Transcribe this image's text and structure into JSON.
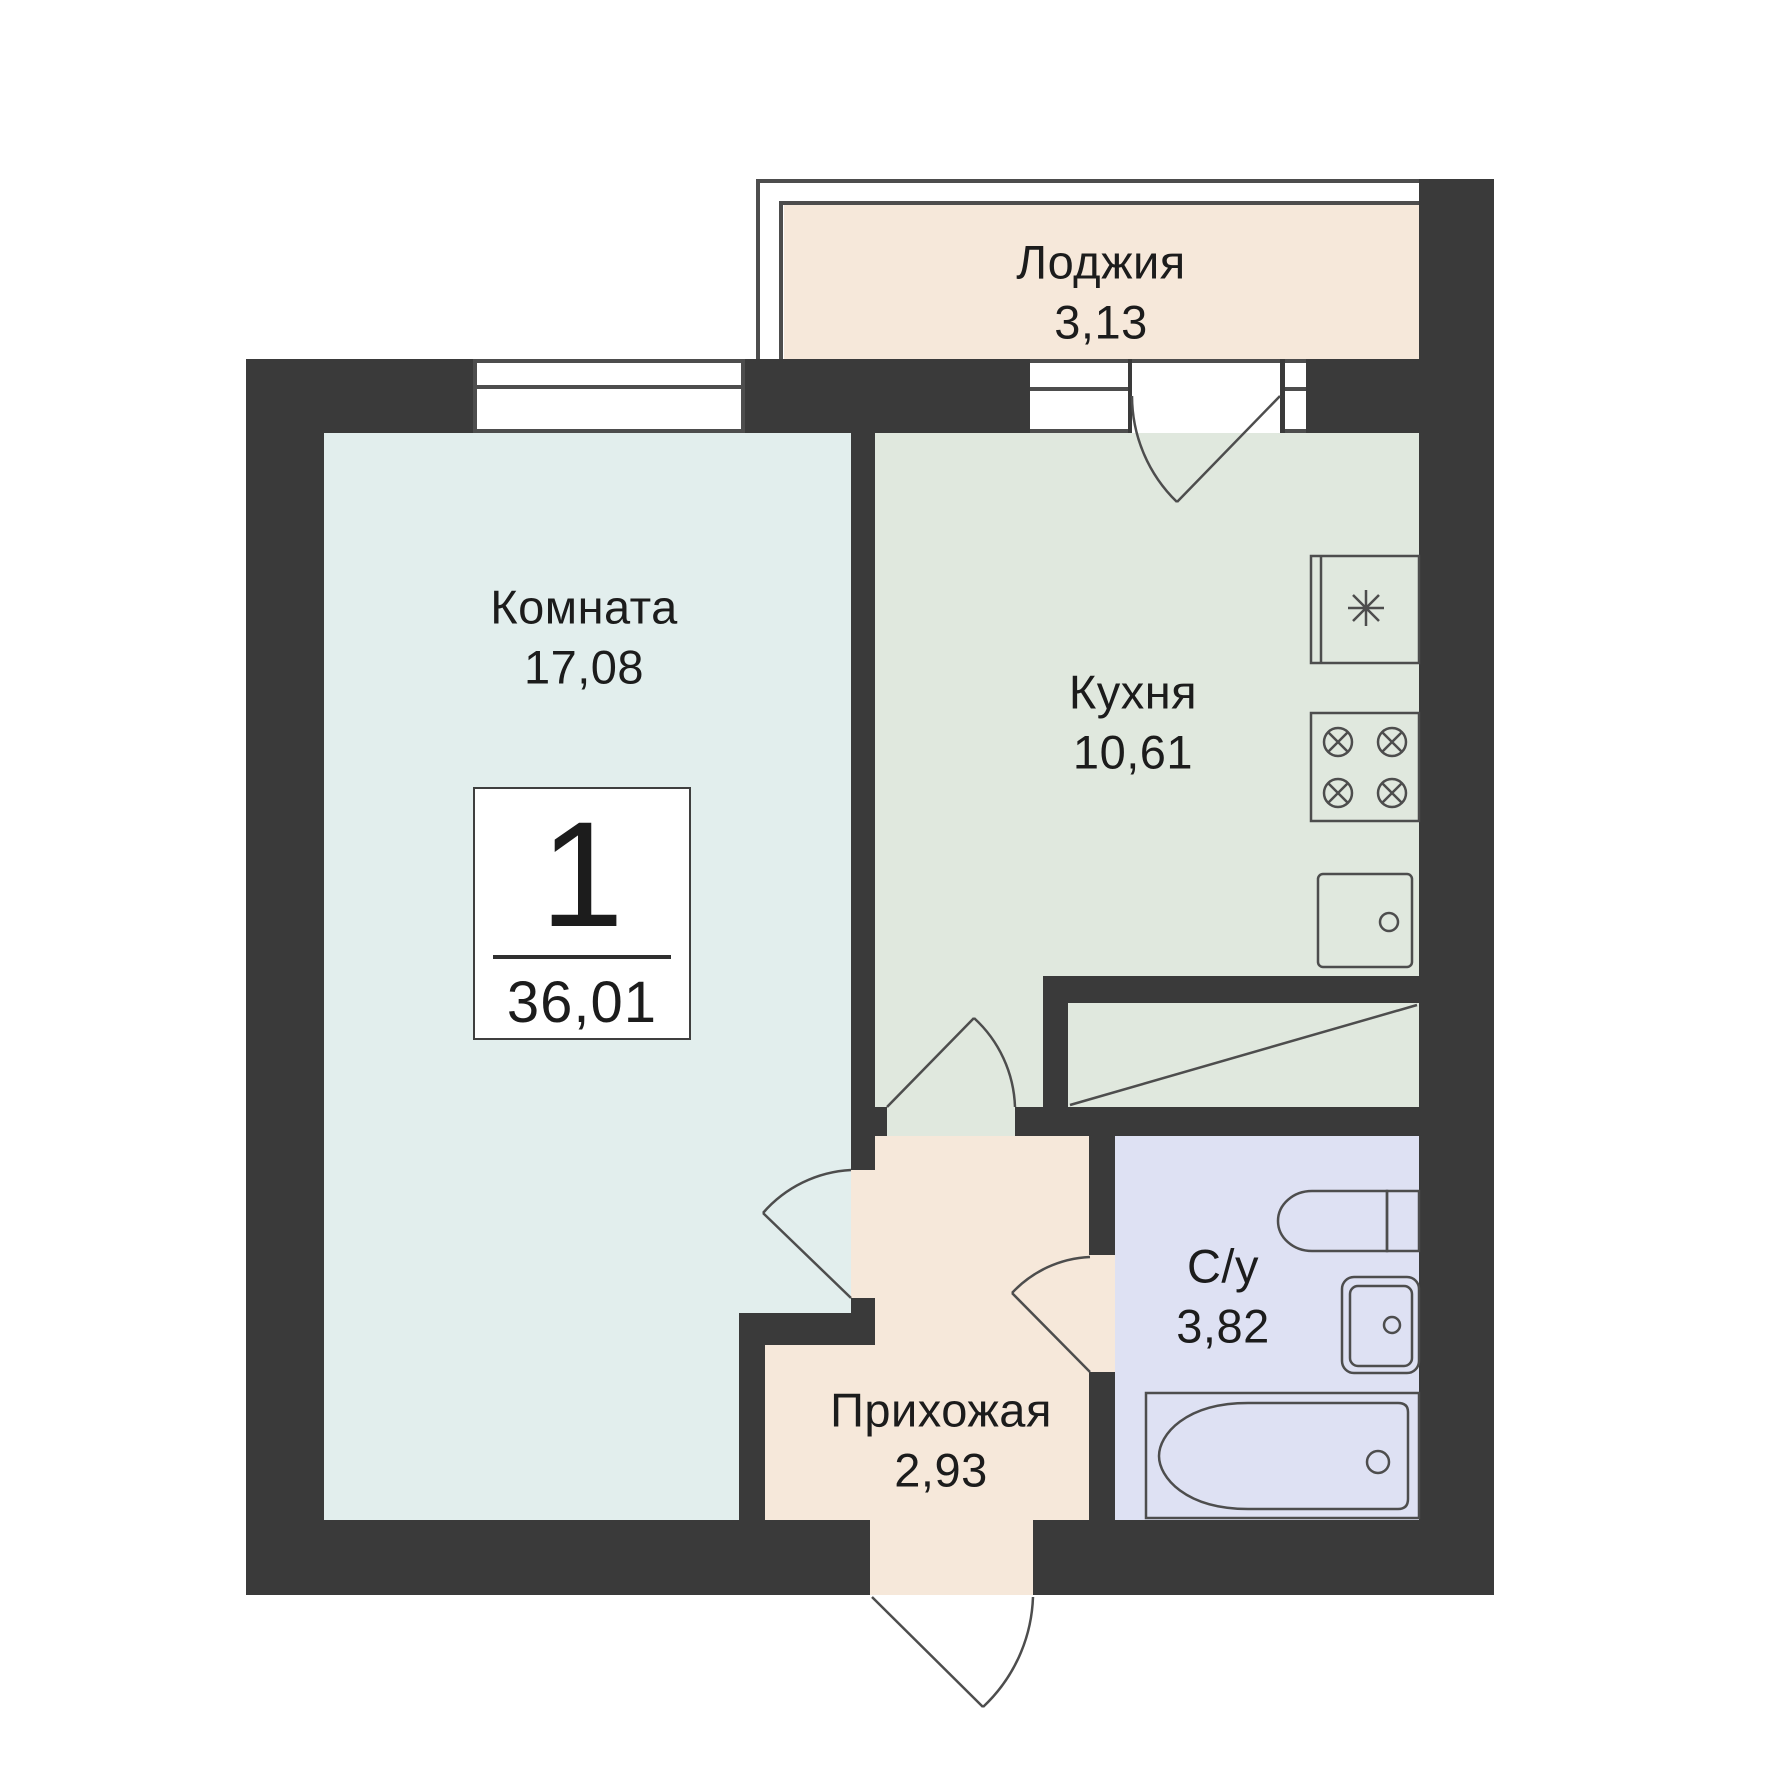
{
  "plan": {
    "title": "1-room apartment floor plan",
    "badge": {
      "room_count": "1",
      "total_area": "36,01"
    },
    "rooms": [
      {
        "id": "loggia",
        "name": "Лоджия",
        "area": "3,13"
      },
      {
        "id": "living",
        "name": "Комната",
        "area": "17,08"
      },
      {
        "id": "kitchen",
        "name": "Кухня",
        "area": "10,61"
      },
      {
        "id": "bathroom",
        "name": "С/у",
        "area": "3,82"
      },
      {
        "id": "hallway",
        "name": "Прихожая",
        "area": "2,93"
      }
    ],
    "icons": {
      "fridge": "asterisk-snowflake",
      "stove": "four-crossed-burner-circles",
      "kitchen_sink": "square-basin-with-drain",
      "toilet": "tank-and-round-bowl",
      "bathroom_sink": "double-basin-with-drain",
      "bathtub": "tub-with-drain-circle"
    },
    "colors": {
      "wall": "#3a3a3a",
      "living_room_fill": "#e2eeed",
      "kitchen_fill": "#e0e8de",
      "loggia_fill": "#f6e8da",
      "hallway_fill": "#f6e8da",
      "bathroom_fill": "#dee1f3",
      "line": "#4d4d4d",
      "text": "#1c1c1c",
      "badge_bg": "#ffffff"
    }
  }
}
